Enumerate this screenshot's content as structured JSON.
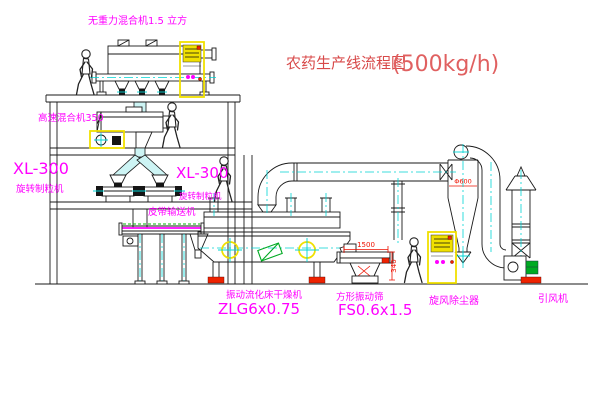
{
  "title": {
    "name": "农药生产线流程图",
    "capacity": "(500kg/h)"
  },
  "labels": {
    "gravity_mixer": "无重力混合机1.5 立方",
    "high_speed_mixer": "高速混合机350",
    "granulator_left_model": "XL-300",
    "granulator_left_type": "旋转制粒机",
    "granulator_right_model": "XL-300",
    "granulator_right_type": "旋转制粒机",
    "belt_conveyor": "皮带输送机",
    "fluid_bed_dryer": "振动流化床干燥机",
    "fluid_bed_dryer_model": "ZLG6x0.75",
    "square_screen": "方形振动筛",
    "square_screen_model": "FS0.6x1.5",
    "cyclone": "旋风除尘器",
    "induced_draft_fan": "引风机"
  },
  "dimensions": {
    "screen_length": "1500",
    "screen_height": "340",
    "cyclone_diameter": "Φ600"
  },
  "colors": {
    "line": "#1a1a1a",
    "label": "#ff00ff",
    "title": "#d84a4a",
    "title_light": "#e06060",
    "dimension": "#ee1100",
    "centerline": "#00d4d4",
    "duct_fill": "#cdf4f4",
    "cabinet": "#f0e000",
    "accent_green": "#00aa22",
    "accent_red": "#ee2200"
  }
}
